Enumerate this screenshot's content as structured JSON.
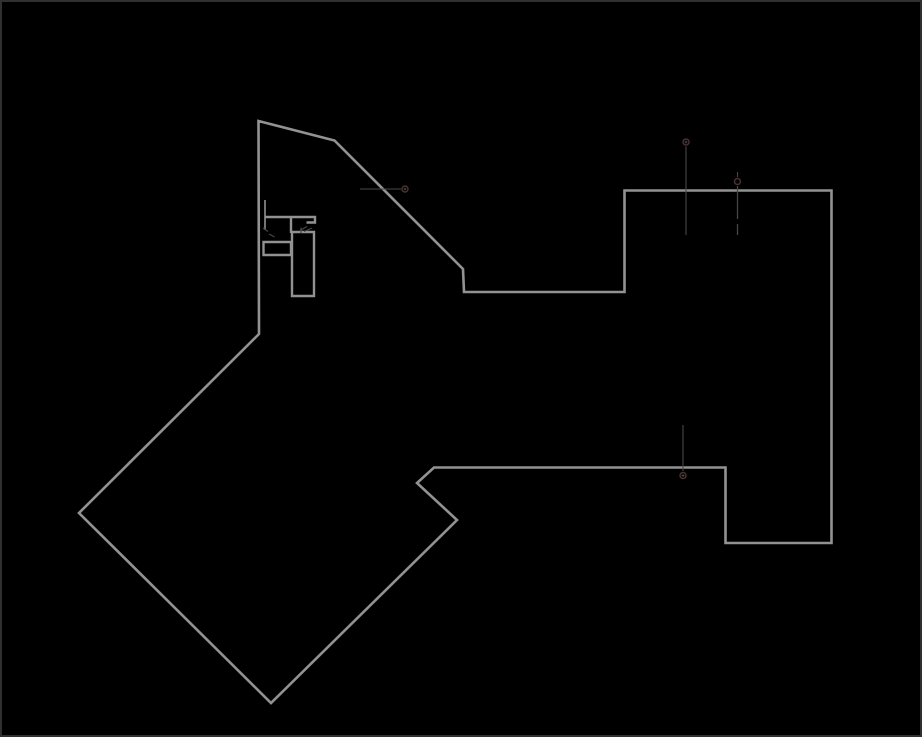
{
  "canvas": {
    "width": 922,
    "height": 737,
    "background": "#000000"
  },
  "colors": {
    "outline": "#929292",
    "thin": "#474747",
    "marker": "#4b3030",
    "border": "#303030"
  },
  "shapes": [
    {
      "name": "canvas-border",
      "type": "rect",
      "x": 1,
      "y": 1,
      "w": 920,
      "h": 735,
      "stroke": "border",
      "width": 2,
      "interactable": false
    },
    {
      "name": "floorplan-outline",
      "type": "path",
      "stroke": "outline",
      "width": 2.6,
      "interactable": true,
      "d": "M 258.5,121 L 334.5,140.5 L 463,269 L 464,292 L 624.5,292 L 624.5,190.5 L 831.5,190.5 L 831.5,543 L 725.5,543 L 725.5,467.5 L 434,467.5 L 417,483 L 457,520 L 271,703 L 79,513 L 259,334 Z"
    },
    {
      "name": "stair-detail-top-edge",
      "type": "path",
      "stroke": "outline",
      "width": 2.4,
      "interactable": true,
      "d": "M 265,217 L 315,217 L 315,222.5 L 306.5,222.5"
    },
    {
      "name": "stair-detail-connector",
      "type": "path",
      "stroke": "outline",
      "width": 2.4,
      "interactable": true,
      "d": "M 291,217 L 291,233"
    },
    {
      "name": "stair-detail-tall-bar",
      "type": "path",
      "stroke": "outline",
      "width": 2.4,
      "interactable": true,
      "d": "M 292,232 L 314,232 L 314,296 L 292,296 Z"
    },
    {
      "name": "stair-detail-horizontal-bar",
      "type": "path",
      "stroke": "outline",
      "width": 2.4,
      "interactable": true,
      "d": "M 263.5,242 L 291,242 L 291,255 L 263.5,255 Z"
    },
    {
      "name": "stair-detail-left-jamb",
      "type": "path",
      "stroke": "outline",
      "width": 1.6,
      "interactable": true,
      "d": "M 265,200 L 265,230"
    },
    {
      "name": "hatch-tick-1",
      "type": "path",
      "stroke": "thin",
      "width": 1.2,
      "interactable": false,
      "d": "M 263,228 L 268,231.5"
    },
    {
      "name": "hatch-tick-2",
      "type": "path",
      "stroke": "thin",
      "width": 1.2,
      "interactable": false,
      "d": "M 269,234 L 274.5,237"
    },
    {
      "name": "hatch-tick-3",
      "type": "path",
      "stroke": "thin",
      "width": 1.2,
      "interactable": false,
      "d": "M 300,230.5 L 307,226.5"
    },
    {
      "name": "hatch-tick-4",
      "type": "path",
      "stroke": "thin",
      "width": 1.2,
      "interactable": false,
      "d": "M 304,231.5 L 312,228"
    },
    {
      "name": "hatch-tick-5",
      "type": "path",
      "stroke": "thin",
      "width": 1.2,
      "interactable": false,
      "d": "M 301,227.5 L 301,233"
    },
    {
      "name": "leader-line-left",
      "type": "path",
      "stroke": "thin",
      "width": 1.1,
      "interactable": true,
      "d": "M 360,189 L 401,189"
    },
    {
      "name": "node-marker-ring-left",
      "type": "circle",
      "cx": 405,
      "cy": 189,
      "r": 3,
      "stroke": "marker",
      "width": 1.5,
      "interactable": true
    },
    {
      "name": "node-marker-cross-left",
      "type": "path",
      "stroke": "thin",
      "width": 1,
      "interactable": false,
      "d": "M 403.6,189 L 406.4,189 M 405,187.6 L 405,190.4"
    },
    {
      "name": "node-marker-ring-top-1",
      "type": "circle",
      "cx": 686,
      "cy": 142,
      "r": 3,
      "stroke": "marker",
      "width": 1.5,
      "interactable": true
    },
    {
      "name": "node-marker-cross-top-1",
      "type": "path",
      "stroke": "thin",
      "width": 1,
      "interactable": false,
      "d": "M 684.6,142 L 687.4,142 M 686,140.6 L 686,143.4"
    },
    {
      "name": "node-drop-line-top-1",
      "type": "path",
      "stroke": "thin",
      "width": 1.1,
      "interactable": true,
      "d": "M 686,146.5 L 686,235"
    },
    {
      "name": "node-tick-top-2",
      "type": "path",
      "stroke": "thin",
      "width": 1.1,
      "interactable": false,
      "d": "M 737.5,172 L 737.5,177"
    },
    {
      "name": "node-marker-ring-top-2",
      "type": "circle",
      "cx": 737.5,
      "cy": 181.5,
      "r": 3,
      "stroke": "marker",
      "width": 1.5,
      "interactable": true
    },
    {
      "name": "node-drop-line-top-2a",
      "type": "path",
      "stroke": "thin",
      "width": 1.3,
      "interactable": true,
      "d": "M 737.5,186 L 737.5,219"
    },
    {
      "name": "node-drop-line-top-2b",
      "type": "path",
      "stroke": "thin",
      "width": 1.3,
      "interactable": true,
      "d": "M 737.5,224 L 737.5,235"
    },
    {
      "name": "node-drop-line-bottom",
      "type": "path",
      "stroke": "thin",
      "width": 1.1,
      "interactable": true,
      "d": "M 683,425 L 683,471"
    },
    {
      "name": "node-marker-ring-bottom",
      "type": "circle",
      "cx": 683,
      "cy": 475.5,
      "r": 3,
      "stroke": "marker",
      "width": 1.5,
      "interactable": true
    },
    {
      "name": "node-marker-cross-bottom",
      "type": "path",
      "stroke": "thin",
      "width": 1,
      "interactable": false,
      "d": "M 681.6,475.5 L 684.4,475.5 M 683,474.1 L 683,476.9"
    }
  ]
}
